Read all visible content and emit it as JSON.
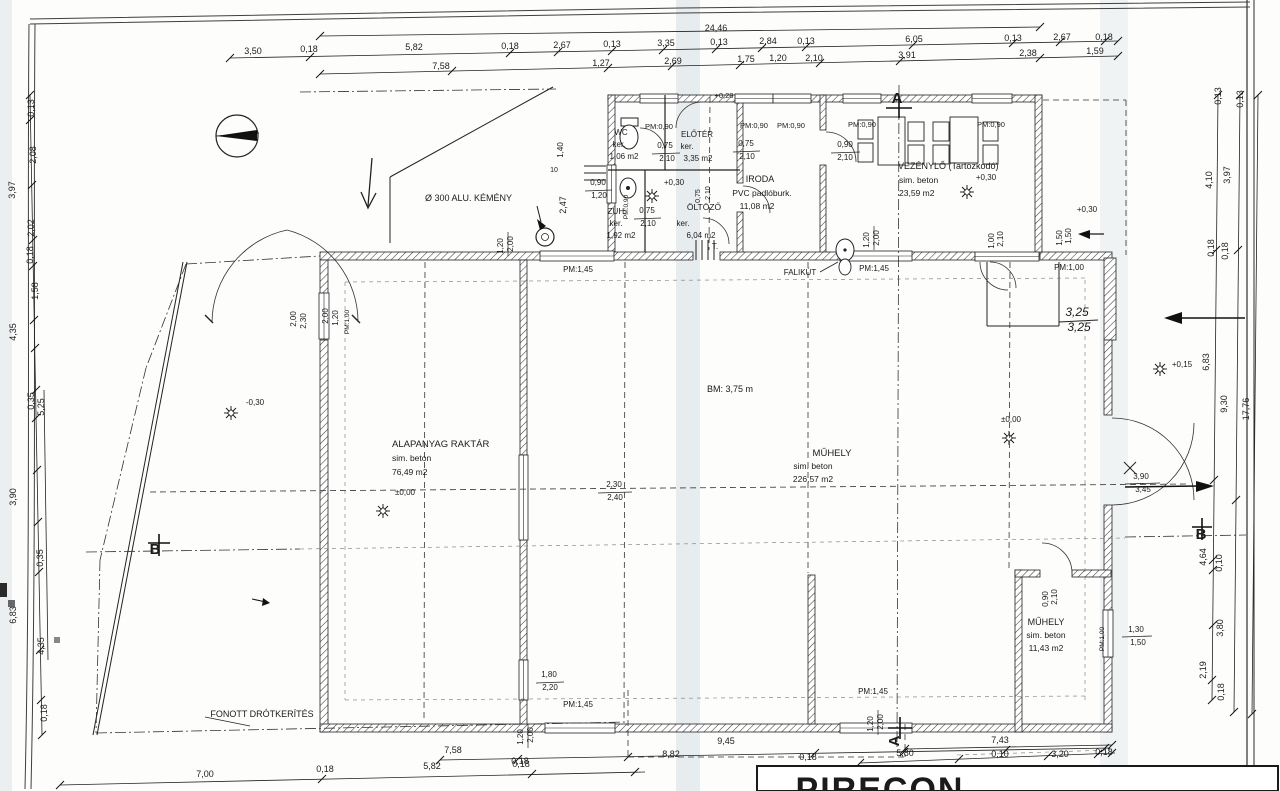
{
  "document": {
    "type": "scanned architectural floor plan",
    "language": "Hungarian",
    "overall_width": "24,46",
    "hall_height_note": "BM: 3,75 m"
  },
  "title_block": {
    "company": "PIRECON"
  },
  "rooms": [
    {
      "name": "WC",
      "finish": "ker.",
      "area": "1,06 m2"
    },
    {
      "name": "ELŐTÉR",
      "finish": "ker.",
      "area": "3,35 m2"
    },
    {
      "name": "ZUH.",
      "finish": "ker.",
      "area": "1,92 m2"
    },
    {
      "name": "ÖLTÖZŐ",
      "finish": "ker.",
      "area": "6,04 m2"
    },
    {
      "name": "IRODA",
      "finish": "PVC padlóburk.",
      "area": "11,08 m2"
    },
    {
      "name": "VEZÉNYLŐ (Tartózkodó)",
      "finish": "sim. beton",
      "area": "23,59 m2"
    },
    {
      "name": "ALAPANYAG RAKTÁR",
      "finish": "sim. beton",
      "area": "76,49 m2"
    },
    {
      "name": "MŰHELY",
      "finish": "sim. beton",
      "area": "226,57 m2"
    },
    {
      "name": "MŰHELY",
      "finish": "sim. beton",
      "area": "11,43 m2"
    }
  ],
  "labels": [
    {
      "t": "24,46",
      "x": 716,
      "y": 31
    },
    {
      "t": "3,50",
      "x": 253,
      "y": 54
    },
    {
      "t": "0,18",
      "x": 309,
      "y": 52
    },
    {
      "t": "5,82",
      "x": 414,
      "y": 50
    },
    {
      "t": "0,18",
      "x": 510,
      "y": 49
    },
    {
      "t": "2,67",
      "x": 562,
      "y": 48
    },
    {
      "t": "0,13",
      "x": 612,
      "y": 47
    },
    {
      "t": "3,35",
      "x": 666,
      "y": 46
    },
    {
      "t": "0,13",
      "x": 719,
      "y": 45
    },
    {
      "t": "2,84",
      "x": 768,
      "y": 44
    },
    {
      "t": "0,13",
      "x": 806,
      "y": 44
    },
    {
      "t": "6,05",
      "x": 914,
      "y": 42
    },
    {
      "t": "0,13",
      "x": 1013,
      "y": 41
    },
    {
      "t": "2,67",
      "x": 1062,
      "y": 40
    },
    {
      "t": "0,18",
      "x": 1104,
      "y": 40
    },
    {
      "t": "7,58",
      "x": 441,
      "y": 69
    },
    {
      "t": "1,27",
      "x": 601,
      "y": 66
    },
    {
      "t": "2,69",
      "x": 673,
      "y": 64
    },
    {
      "t": "1,75",
      "x": 746,
      "y": 62
    },
    {
      "t": "1,20",
      "x": 778,
      "y": 61
    },
    {
      "t": "2,10",
      "x": 814,
      "y": 61
    },
    {
      "t": "3,91",
      "x": 907,
      "y": 58
    },
    {
      "t": "2,38",
      "x": 1028,
      "y": 56
    },
    {
      "t": "1,59",
      "x": 1095,
      "y": 54
    },
    {
      "t": "0,13",
      "x": 34,
      "y": 108,
      "r": -90
    },
    {
      "t": "2,08",
      "x": 36,
      "y": 155,
      "r": -90
    },
    {
      "t": "3,97",
      "x": 15,
      "y": 190,
      "r": -90
    },
    {
      "t": "2,02",
      "x": 34,
      "y": 228,
      "r": -90
    },
    {
      "t": "0,18",
      "x": 33,
      "y": 255,
      "r": -90
    },
    {
      "t": "1,58",
      "x": 38,
      "y": 291,
      "r": -90
    },
    {
      "t": "4,35",
      "x": 16,
      "y": 332,
      "r": -90
    },
    {
      "t": "0,35",
      "x": 34,
      "y": 401,
      "r": -90
    },
    {
      "t": "5,25",
      "x": 44,
      "y": 407,
      "r": -90
    },
    {
      "t": "3,90",
      "x": 16,
      "y": 497,
      "r": -90
    },
    {
      "t": "0,35",
      "x": 43,
      "y": 558,
      "r": -90
    },
    {
      "t": "6,83",
      "x": 16,
      "y": 615,
      "r": -90
    },
    {
      "t": "4,35",
      "x": 44,
      "y": 646,
      "r": -90
    },
    {
      "t": "0,18",
      "x": 47,
      "y": 713,
      "r": -90
    },
    {
      "t": "0,13",
      "x": 1221,
      "y": 96,
      "r": -90
    },
    {
      "t": "0,13",
      "x": 1243,
      "y": 99,
      "r": -90
    },
    {
      "t": "4,10",
      "x": 1212,
      "y": 180,
      "r": -90
    },
    {
      "t": "3,97",
      "x": 1230,
      "y": 175,
      "r": -90
    },
    {
      "t": "0,18",
      "x": 1214,
      "y": 248,
      "r": -90
    },
    {
      "t": "0,18",
      "x": 1228,
      "y": 251,
      "r": -90
    },
    {
      "t": "6,83",
      "x": 1209,
      "y": 362,
      "r": -90
    },
    {
      "t": "9,30",
      "x": 1227,
      "y": 404,
      "r": -90
    },
    {
      "t": "17,76",
      "x": 1249,
      "y": 409,
      "r": -90
    },
    {
      "t": "4,64",
      "x": 1206,
      "y": 557,
      "r": -90
    },
    {
      "t": "0,10",
      "x": 1222,
      "y": 563,
      "r": -90
    },
    {
      "t": "3,80",
      "x": 1223,
      "y": 628,
      "r": -90
    },
    {
      "t": "2,19",
      "x": 1206,
      "y": 670,
      "r": -90
    },
    {
      "t": "0,18",
      "x": 1224,
      "y": 692,
      "r": -90
    },
    {
      "t": "+0,15",
      "x": 1182,
      "y": 367,
      "s": 8,
      "n": "level-mark"
    },
    {
      "t": "3,25",
      "x": 1077,
      "y": 316,
      "s": 12,
      "f": "italic",
      "n": "handwritten-dim"
    },
    {
      "t": "3,25",
      "x": 1079,
      "y": 331,
      "s": 12,
      "f": "italic",
      "n": "handwritten-dim"
    },
    {
      "t": "3,90",
      "x": 1141,
      "y": 479,
      "s": 8
    },
    {
      "t": "3,45",
      "x": 1143,
      "y": 492,
      "s": 8
    },
    {
      "t": "1,30",
      "x": 1136,
      "y": 632,
      "s": 8
    },
    {
      "t": "1,50",
      "x": 1138,
      "y": 645,
      "s": 8
    },
    {
      "t": "B",
      "x": 1201,
      "y": 539,
      "s": 15,
      "w": "bold",
      "n": "section-marker-b"
    },
    {
      "t": "B",
      "x": 155,
      "y": 554,
      "s": 15,
      "w": "bold",
      "n": "section-marker-b"
    },
    {
      "t": "A",
      "x": 897,
      "y": 103,
      "s": 15,
      "w": "bold",
      "n": "section-marker-a"
    },
    {
      "t": "A",
      "x": 899,
      "y": 741,
      "s": 15,
      "w": "bold",
      "r": -90,
      "n": "section-marker-a"
    },
    {
      "t": "9,45",
      "x": 726,
      "y": 744
    },
    {
      "t": "7,58",
      "x": 453,
      "y": 753
    },
    {
      "t": "0,18",
      "x": 520,
      "y": 764
    },
    {
      "t": "8,82",
      "x": 671,
      "y": 757
    },
    {
      "t": "0,18",
      "x": 808,
      "y": 760
    },
    {
      "t": "7,43",
      "x": 1000,
      "y": 743
    },
    {
      "t": "5,80",
      "x": 905,
      "y": 756
    },
    {
      "t": "0,10",
      "x": 1000,
      "y": 757
    },
    {
      "t": "3,20",
      "x": 1060,
      "y": 757
    },
    {
      "t": "0,18",
      "x": 1104,
      "y": 755
    },
    {
      "t": "7,00",
      "x": 205,
      "y": 777
    },
    {
      "t": "0,18",
      "x": 325,
      "y": 772
    },
    {
      "t": "5,82",
      "x": 432,
      "y": 769
    },
    {
      "t": "0,18",
      "x": 521,
      "y": 767
    },
    {
      "t": "1,20",
      "x": 523,
      "y": 737,
      "r": -90,
      "s": 8
    },
    {
      "t": "2,00",
      "x": 533,
      "y": 735,
      "r": -90,
      "s": 8
    },
    {
      "t": "1,20",
      "x": 873,
      "y": 724,
      "r": -90,
      "s": 8
    },
    {
      "t": "2,00",
      "x": 883,
      "y": 722,
      "r": -90,
      "s": 8
    },
    {
      "t": "PM:1,45",
      "x": 578,
      "y": 707,
      "s": 8
    },
    {
      "t": "PM:1,45",
      "x": 873,
      "y": 694,
      "s": 8
    },
    {
      "t": "1,80",
      "x": 549,
      "y": 677,
      "s": 8
    },
    {
      "t": "2,20",
      "x": 550,
      "y": 690,
      "s": 8
    },
    {
      "t": "WC",
      "x": 621,
      "y": 135,
      "s": 8,
      "n": "room-name"
    },
    {
      "t": "ker.",
      "x": 619,
      "y": 147,
      "s": 8
    },
    {
      "t": "1,06 m2",
      "x": 624,
      "y": 159,
      "s": 8,
      "n": "room-area"
    },
    {
      "t": "ELŐTÉR",
      "x": 697,
      "y": 137,
      "s": 8,
      "n": "room-name"
    },
    {
      "t": "ker.",
      "x": 687,
      "y": 149,
      "s": 8
    },
    {
      "t": "3,35 m2",
      "x": 698,
      "y": 161,
      "s": 8,
      "n": "room-area"
    },
    {
      "t": "0,75",
      "x": 665,
      "y": 148,
      "s": 8
    },
    {
      "t": "2,10",
      "x": 667,
      "y": 161,
      "s": 8
    },
    {
      "t": "0,75",
      "x": 746,
      "y": 146,
      "s": 8
    },
    {
      "t": "2,10",
      "x": 747,
      "y": 159,
      "s": 8
    },
    {
      "t": "PM:0,90",
      "x": 659,
      "y": 129,
      "s": 7.5
    },
    {
      "t": "PM:0,90",
      "x": 754,
      "y": 128,
      "s": 7.5
    },
    {
      "t": "PM:0,90",
      "x": 791,
      "y": 128,
      "s": 7.5
    },
    {
      "t": "PM:0,90",
      "x": 862,
      "y": 127,
      "s": 7.5
    },
    {
      "t": "PM:0,90",
      "x": 991,
      "y": 127,
      "s": 7.5
    },
    {
      "t": "+0,28",
      "x": 724,
      "y": 98,
      "s": 7.5,
      "n": "level-mark"
    },
    {
      "t": "ZUH.",
      "x": 617,
      "y": 214,
      "s": 8,
      "n": "room-name"
    },
    {
      "t": "ker.",
      "x": 616,
      "y": 226,
      "s": 8
    },
    {
      "t": "1,92 m2",
      "x": 621,
      "y": 238,
      "s": 8,
      "n": "room-area"
    },
    {
      "t": "PM:0,90",
      "x": 628,
      "y": 207,
      "r": -90,
      "s": 6.5
    },
    {
      "t": "+0,30",
      "x": 674,
      "y": 185,
      "s": 8,
      "n": "level-mark"
    },
    {
      "t": "ÖLTÖZŐ",
      "x": 704,
      "y": 210,
      "s": 8.5,
      "n": "room-name"
    },
    {
      "t": "ker.",
      "x": 683,
      "y": 226,
      "s": 8
    },
    {
      "t": "6,04 m2",
      "x": 701,
      "y": 238,
      "s": 8,
      "n": "room-area"
    },
    {
      "t": "0,75",
      "x": 647,
      "y": 213,
      "s": 8
    },
    {
      "t": "2,10",
      "x": 648,
      "y": 226,
      "s": 8
    },
    {
      "t": "0,75",
      "x": 700,
      "y": 196,
      "r": -90,
      "s": 7
    },
    {
      "t": "2,10",
      "x": 710,
      "y": 193,
      "r": -90,
      "s": 7
    },
    {
      "t": "T.",
      "x": 715,
      "y": 249,
      "s": 8
    },
    {
      "t": "IRODA",
      "x": 760,
      "y": 182,
      "s": 9,
      "n": "room-name"
    },
    {
      "t": "PVC padlóburk.",
      "x": 762,
      "y": 196,
      "s": 8.5
    },
    {
      "t": "11,08 m2",
      "x": 757,
      "y": 209,
      "s": 8.5,
      "n": "room-area"
    },
    {
      "t": "VEZÉNYLŐ (Tartózkodó)",
      "x": 898,
      "y": 169,
      "s": 9,
      "a": "start",
      "n": "room-name"
    },
    {
      "t": "sim. beton",
      "x": 899,
      "y": 183,
      "s": 8.5,
      "a": "start"
    },
    {
      "t": "23,59 m2",
      "x": 899,
      "y": 196,
      "s": 8.5,
      "a": "start",
      "n": "room-area"
    },
    {
      "t": "+0,30",
      "x": 986,
      "y": 180,
      "s": 8,
      "n": "level-mark"
    },
    {
      "t": "0,90",
      "x": 845,
      "y": 147,
      "s": 8
    },
    {
      "t": "2,10",
      "x": 845,
      "y": 160,
      "s": 8
    },
    {
      "t": "0,90",
      "x": 598,
      "y": 185,
      "s": 8
    },
    {
      "t": "1,20",
      "x": 599,
      "y": 198,
      "s": 8
    },
    {
      "t": "1,40",
      "x": 563,
      "y": 150,
      "r": -90,
      "s": 8
    },
    {
      "t": "2,47",
      "x": 566,
      "y": 205,
      "r": -90,
      "s": 9
    },
    {
      "t": "10",
      "x": 554,
      "y": 172,
      "s": 7
    },
    {
      "t": "Ø 300 ALU. KÉMÉNY",
      "x": 425,
      "y": 201,
      "s": 9,
      "a": "start",
      "n": "callout-chimney"
    },
    {
      "t": "2,00",
      "x": 296,
      "y": 319,
      "r": -90,
      "s": 8
    },
    {
      "t": "2,30",
      "x": 306,
      "y": 321,
      "r": -90,
      "s": 8
    },
    {
      "t": "2,00",
      "x": 328,
      "y": 316,
      "r": -90,
      "s": 8
    },
    {
      "t": "1,20",
      "x": 338,
      "y": 318,
      "r": -90,
      "s": 8
    },
    {
      "t": "PM:1,00",
      "x": 349,
      "y": 322,
      "r": -90,
      "s": 6.5
    },
    {
      "t": "1,20",
      "x": 503,
      "y": 246,
      "r": -90,
      "s": 8
    },
    {
      "t": "2,00",
      "x": 513,
      "y": 244,
      "r": -90,
      "s": 8
    },
    {
      "t": "PM:1,45",
      "x": 578,
      "y": 272,
      "s": 8
    },
    {
      "t": "PM:1,45",
      "x": 874,
      "y": 271,
      "s": 8
    },
    {
      "t": "FALIKÚT",
      "x": 800,
      "y": 275,
      "s": 8,
      "n": "callout-wall-tap"
    },
    {
      "t": "1,20",
      "x": 869,
      "y": 240,
      "r": -90,
      "s": 8
    },
    {
      "t": "2,00",
      "x": 879,
      "y": 238,
      "r": -90,
      "s": 8
    },
    {
      "t": "1,00",
      "x": 994,
      "y": 241,
      "r": -90,
      "s": 8
    },
    {
      "t": "2,10",
      "x": 1003,
      "y": 239,
      "r": -90,
      "s": 8
    },
    {
      "t": "PM:1,00",
      "x": 1069,
      "y": 270,
      "s": 8
    },
    {
      "t": "1,50",
      "x": 1062,
      "y": 238,
      "r": -90,
      "s": 8
    },
    {
      "t": "1,50",
      "x": 1071,
      "y": 236,
      "r": -90,
      "s": 8
    },
    {
      "t": "+0,30",
      "x": 1087,
      "y": 212,
      "s": 8,
      "n": "level-mark"
    },
    {
      "t": "ALAPANYAG RAKTÁR",
      "x": 392,
      "y": 447,
      "s": 9.5,
      "a": "start",
      "n": "room-name"
    },
    {
      "t": "sim. beton",
      "x": 392,
      "y": 461,
      "s": 8.5,
      "a": "start"
    },
    {
      "t": "76,49 m2",
      "x": 392,
      "y": 475,
      "s": 8.5,
      "a": "start",
      "n": "room-area"
    },
    {
      "t": "±0,00",
      "x": 405,
      "y": 495,
      "s": 8,
      "n": "level-mark"
    },
    {
      "t": "-0,30",
      "x": 255,
      "y": 405,
      "s": 8,
      "n": "level-mark"
    },
    {
      "t": "BM: 3,75 m",
      "x": 730,
      "y": 392,
      "s": 9,
      "n": "height-note"
    },
    {
      "t": "MŰHELY",
      "x": 832,
      "y": 456,
      "s": 9.5,
      "n": "room-name"
    },
    {
      "t": "sim. beton",
      "x": 813,
      "y": 469,
      "s": 8.5
    },
    {
      "t": "226,57 m2",
      "x": 813,
      "y": 482,
      "s": 8.5,
      "n": "room-area"
    },
    {
      "t": "±0,00",
      "x": 1011,
      "y": 422,
      "s": 8,
      "n": "level-mark"
    },
    {
      "t": "2,30",
      "x": 614,
      "y": 487,
      "s": 8
    },
    {
      "t": "2,40",
      "x": 615,
      "y": 500,
      "s": 8
    },
    {
      "t": "MŰHELY",
      "x": 1046,
      "y": 625,
      "s": 9,
      "n": "room-name"
    },
    {
      "t": "sim. beton",
      "x": 1046,
      "y": 638,
      "s": 8.5
    },
    {
      "t": "11,43 m2",
      "x": 1046,
      "y": 651,
      "s": 8.5,
      "n": "room-area"
    },
    {
      "t": "0,90",
      "x": 1048,
      "y": 599,
      "r": -90,
      "s": 8
    },
    {
      "t": "2,10",
      "x": 1057,
      "y": 597,
      "r": -90,
      "s": 8
    },
    {
      "t": "PM:1,00",
      "x": 1104,
      "y": 639,
      "r": -90,
      "s": 6.5
    },
    {
      "t": "FONOTT DRÓTKERÍTÉS",
      "x": 262,
      "y": 717,
      "s": 9,
      "n": "callout-fence"
    },
    {
      "t": "PIRECON",
      "x": 880,
      "y": 801,
      "s": 34,
      "w": "bold",
      "n": "title-block-company"
    }
  ]
}
